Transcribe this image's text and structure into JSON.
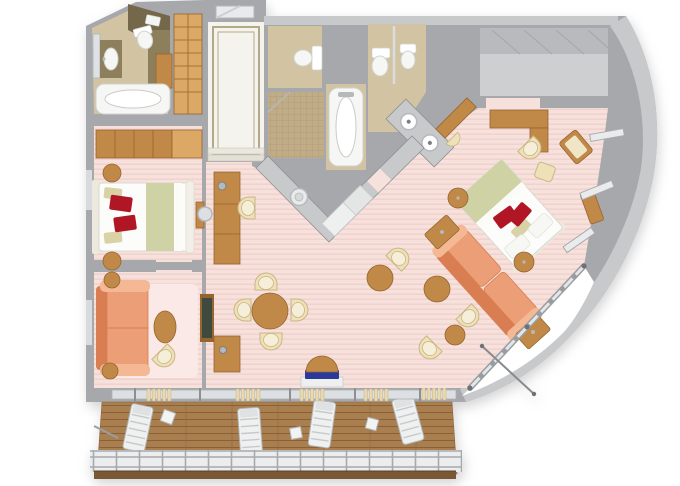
{
  "meta": {
    "type": "3d-floor-plan",
    "subject": "cruise-ship-suite-with-veranda",
    "view": "top-down-3d-render",
    "canvas": {
      "width": 680,
      "height": 486
    }
  },
  "palette": {
    "white": "#ffffff",
    "wallMid": "#a6a8ab",
    "wallLight": "#c7c9cb",
    "wallLighter": "#dadcde",
    "wallDark": "#8d8f92",
    "floorPink": "#f7e1dd",
    "floorPinkStripe": "#f1d3ce",
    "rugPink": "#fae9e6",
    "marbleWhite": "#f5f3ed",
    "marbleBorder": "#b3a888",
    "marbleBeige": "#d2c3a3",
    "marbleBeigeDark": "#c0ad87",
    "mosaicLine": "#ab9878",
    "granite": "#75684a",
    "graniteMid": "#8d7f5c",
    "wood": "#c18948",
    "woodDark": "#96642f",
    "woodLight": "#dca865",
    "deck": "#aa7f50",
    "deckLine": "#8a6136",
    "salmon": "#ec9e77",
    "salmonDark": "#d87e52",
    "salmonLight": "#f4b994",
    "cream": "#eee1b8",
    "creamDark": "#cbb584",
    "creamSeat": "#f5eed8",
    "bedWhite": "#fcfcfa",
    "bedGreen": "#ced2a4",
    "pillowKhaki": "#d8d2a6",
    "redPillow": "#b01623",
    "navy": "#2b3a9a",
    "metal": "#b6b9bc",
    "metalDark": "#7c7f82",
    "tubWhite": "#f6f7f5",
    "tubLine": "#cfd3cf",
    "glass": "#dde0e2",
    "tvScreen": "#3f4a3f",
    "fascia": "#7a5836"
  },
  "scene": {
    "exterior": [
      "curved-hull-wall",
      "balcony-deck",
      "deck-railing",
      "balcony-cable"
    ],
    "rooms": [
      {
        "id": "entry-foyer",
        "floor": "white-marble-inlay",
        "items": [
          "entry-door",
          "marble-border",
          "steps"
        ]
      },
      {
        "id": "guest-bathroom",
        "floor": "beige-marble",
        "items": [
          "mirror",
          "vanity-sink",
          "toilet",
          "granite-wall",
          "towel-shelf",
          "wood-cabinet",
          "bathtub"
        ]
      },
      {
        "id": "hall-wardrobe",
        "items": [
          "shelving-unit"
        ]
      },
      {
        "id": "guest-bedroom",
        "floor": "pink-carpet",
        "items": [
          "wardrobe",
          "corner-cabinet",
          "double-bed",
          "red-pillows",
          "khaki-pillows",
          "nightstand-top",
          "nightstand-bottom",
          "dresser",
          "round-mirror"
        ]
      },
      {
        "id": "guest-sitting-room",
        "floor": "pink-carpet",
        "items": [
          "rug",
          "sofa",
          "end-table-top",
          "end-table-bottom",
          "oval-coffee-table",
          "tub-chair",
          "tv-panel"
        ]
      },
      {
        "id": "master-bathroom",
        "items": [
          "toilet-room-toilet",
          "mosaic-shower",
          "bathtub",
          "toilet",
          "bidet",
          "double-sink-vanity"
        ]
      },
      {
        "id": "dressing-area",
        "floor": "pink-carpet",
        "items": [
          "dressing-table",
          "stool"
        ]
      },
      {
        "id": "walk-in-closet",
        "items": [
          "open-shelf-interior"
        ]
      },
      {
        "id": "living-dining-room",
        "floor": "pink-carpet",
        "items": [
          "wet-bar-counter",
          "bar-sink",
          "appliance-units",
          "doorway",
          "sideboard",
          "lamp",
          "tv-cabinet",
          "cabinet-lamp",
          "dining-table",
          "dining-chairs",
          "navy-bench",
          "tub-chairs",
          "round-side-tables"
        ]
      },
      {
        "id": "master-bedroom",
        "floor": "pink-carpet",
        "items": [
          "desk",
          "desk-chair",
          "ottoman",
          "armchair",
          "window-bench",
          "double-bed",
          "red-pillows",
          "nightstand-upper",
          "nightstand-lower",
          "sofa",
          "end-cabinet-upper",
          "end-cabinet-lower",
          "curved-windows",
          "window-wall"
        ]
      },
      {
        "id": "balcony",
        "floor": "teak-deck",
        "items": [
          "threshold-mats",
          "sun-loungers",
          "side-tables",
          "railing",
          "davit-pole"
        ]
      }
    ]
  }
}
